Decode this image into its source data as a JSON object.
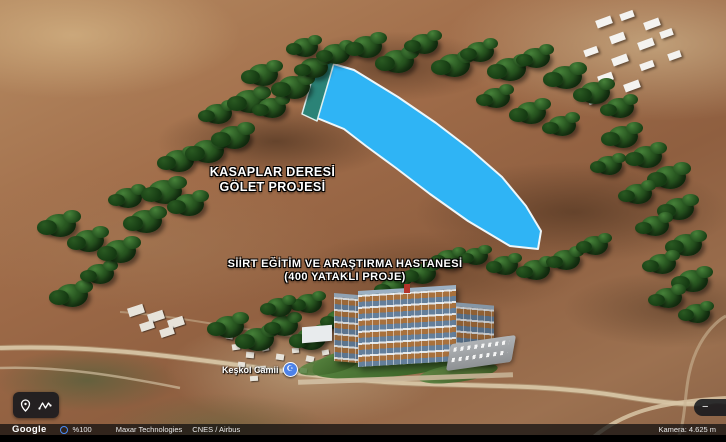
{
  "labels": {
    "golet": {
      "line1": "KASAPLAR DERESİ",
      "line2": "GÖLET PROJESİ"
    },
    "hospital": {
      "line1": "SİİRT EĞİTİM VE ARAŞTIRMA HASTANESİ",
      "line2": "(400 YATAKLI PROJE)"
    }
  },
  "place": {
    "name": "Keşkol Camii",
    "pin_glyph": "☪"
  },
  "statusbar": {
    "brand": "Google",
    "zoom_percent": "%100",
    "attribution_1": "Maxar Technologies",
    "attribution_2": "CNES / Airbus",
    "camera": "Kamera: 4.625 m"
  },
  "zoom_control": {
    "minus": "−",
    "plus": "+"
  },
  "colors": {
    "lake": "#2fb4f5",
    "dam": "#2b8377",
    "accent": "#4b8df8",
    "poi": "#4d82e8",
    "tree_light": "#47823a",
    "tree_mid": "#2a5a22",
    "tree_dark": "#153a12"
  },
  "scene": {
    "lake_path": "M327,62 L354,70 L398,97 L436,123 L470,149 L502,177 L526,206 L541,231 L538,249 L510,246 L468,221 L430,194 L396,168 L366,146 L344,129 L312,116 Z",
    "dam_path": "M318,59 L334,63 L317,121 L302,114 Z",
    "trees": [
      [
        44,
        214,
        32
      ],
      [
        74,
        230,
        30
      ],
      [
        56,
        284,
        32
      ],
      [
        86,
        264,
        28
      ],
      [
        104,
        240,
        32
      ],
      [
        130,
        210,
        32
      ],
      [
        114,
        188,
        28
      ],
      [
        148,
        180,
        34
      ],
      [
        174,
        194,
        30
      ],
      [
        164,
        150,
        30
      ],
      [
        192,
        140,
        32
      ],
      [
        218,
        126,
        32
      ],
      [
        204,
        104,
        28
      ],
      [
        234,
        90,
        32
      ],
      [
        258,
        98,
        28
      ],
      [
        248,
        64,
        30
      ],
      [
        278,
        76,
        32
      ],
      [
        300,
        58,
        28
      ],
      [
        292,
        38,
        26
      ],
      [
        322,
        44,
        28
      ],
      [
        352,
        36,
        30
      ],
      [
        382,
        50,
        32
      ],
      [
        410,
        34,
        28
      ],
      [
        438,
        54,
        32
      ],
      [
        466,
        42,
        28
      ],
      [
        494,
        58,
        32
      ],
      [
        522,
        48,
        28
      ],
      [
        550,
        66,
        32
      ],
      [
        580,
        82,
        30
      ],
      [
        606,
        98,
        28
      ],
      [
        482,
        88,
        28
      ],
      [
        516,
        102,
        30
      ],
      [
        548,
        116,
        28
      ],
      [
        608,
        126,
        30
      ],
      [
        632,
        146,
        30
      ],
      [
        596,
        156,
        26
      ],
      [
        654,
        166,
        32
      ],
      [
        624,
        184,
        28
      ],
      [
        664,
        198,
        30
      ],
      [
        641,
        216,
        28
      ],
      [
        672,
        234,
        30
      ],
      [
        648,
        254,
        28
      ],
      [
        678,
        270,
        30
      ],
      [
        654,
        288,
        28
      ],
      [
        684,
        304,
        26
      ],
      [
        214,
        316,
        30
      ],
      [
        242,
        328,
        32
      ],
      [
        270,
        316,
        28
      ],
      [
        296,
        328,
        30
      ],
      [
        326,
        310,
        28
      ],
      [
        352,
        294,
        30
      ],
      [
        380,
        278,
        28
      ],
      [
        408,
        264,
        28
      ],
      [
        436,
        250,
        26
      ],
      [
        296,
        294,
        26
      ],
      [
        266,
        298,
        26
      ],
      [
        464,
        248,
        24
      ],
      [
        492,
        256,
        26
      ],
      [
        522,
        260,
        28
      ],
      [
        552,
        250,
        28
      ],
      [
        582,
        236,
        26
      ]
    ],
    "town_buildings": [
      [
        128,
        306,
        16,
        9,
        -18
      ],
      [
        148,
        312,
        16,
        9,
        -18
      ],
      [
        168,
        318,
        16,
        9,
        -18
      ],
      [
        140,
        322,
        14,
        8,
        -18
      ],
      [
        160,
        328,
        14,
        8,
        -18
      ],
      [
        226,
        334,
        7,
        5,
        10
      ],
      [
        232,
        344,
        8,
        6,
        -8
      ],
      [
        246,
        352,
        8,
        6,
        5
      ],
      [
        262,
        346,
        7,
        5,
        -12
      ],
      [
        276,
        354,
        8,
        6,
        8
      ],
      [
        292,
        348,
        7,
        5,
        -5
      ],
      [
        306,
        356,
        8,
        6,
        12
      ],
      [
        322,
        350,
        7,
        5,
        -10
      ],
      [
        238,
        362,
        7,
        5,
        6
      ],
      [
        258,
        366,
        8,
        5,
        -6
      ],
      [
        282,
        368,
        7,
        5,
        10
      ],
      [
        250,
        376,
        8,
        5,
        -4
      ],
      [
        300,
        368,
        7,
        5,
        7
      ],
      [
        318,
        364,
        7,
        5,
        -9
      ],
      [
        334,
        370,
        7,
        5,
        5
      ]
    ],
    "industrial_buildings": [
      [
        596,
        18,
        16,
        8,
        -20
      ],
      [
        620,
        12,
        14,
        7,
        -20
      ],
      [
        644,
        20,
        16,
        8,
        -20
      ],
      [
        610,
        34,
        15,
        8,
        -20
      ],
      [
        638,
        40,
        16,
        8,
        -20
      ],
      [
        584,
        48,
        14,
        7,
        -20
      ],
      [
        612,
        56,
        16,
        8,
        -20
      ],
      [
        640,
        62,
        14,
        7,
        -20
      ],
      [
        598,
        74,
        15,
        8,
        -20
      ],
      [
        624,
        82,
        16,
        8,
        -20
      ],
      [
        588,
        96,
        14,
        7,
        -20
      ],
      [
        660,
        30,
        13,
        7,
        -20
      ],
      [
        668,
        52,
        13,
        7,
        -20
      ]
    ]
  }
}
